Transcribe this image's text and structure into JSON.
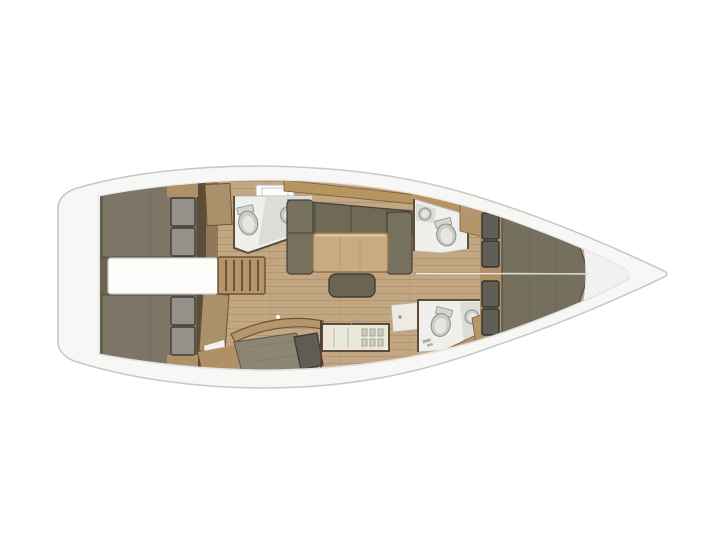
{
  "scene": {
    "type": "yacht-interior-floorplan",
    "view": "top-down",
    "orientation": "bow-right",
    "components": [
      "transom",
      "aft-cabin-top",
      "aft-cabin-bottom",
      "engine-compartment",
      "companionway-steps",
      "saloon",
      "saloon-settee",
      "saloon-table",
      "forward-head-port",
      "nav-chart-area",
      "galley",
      "shower-stall",
      "aft-head-starboard",
      "forward-head-starboard",
      "corridor",
      "forward-cabin",
      "v-berth",
      "bow-locker"
    ]
  },
  "colors": {
    "background": "#ffffff",
    "hull_fill": "#f7f7f5",
    "hull_outline": "#c9c9c6",
    "deck": "#eae9e5",
    "wood_floor": "#c3a783",
    "wood_plank_line": "#ab9270",
    "wood_wall": "#91785a",
    "wall_brown": "#5d4c38",
    "trim_brown": "#6e5333",
    "cabinetry_tan": "#b5956c",
    "cabinetry_dark_tan": "#b09066",
    "sloped_band_tan": "#b79560",
    "aft_band": "#6b654f",
    "berth_olive": "#7d7667",
    "vberth_olive": "#75705e",
    "settee_back": "#6f6958",
    "settee_arm": "#76705f",
    "cushion_outline": "#454134",
    "ottoman": "#6b6453",
    "pillow_gray": "#93918a",
    "pillow_dark": "#605e57",
    "table_wood": "#c9aa82",
    "table_edge": "#97764d",
    "engine_white": "#fcfcfa",
    "fixture_white": "#eff0ec",
    "fixture_outline": "#b7b7b2",
    "porcelain": "#c9cbc7",
    "porcelain_inner": "#e6e7e3",
    "counter_gray": "#dcddd8",
    "galley_counter": "#e9e7da",
    "shower_tile": "#edebe4",
    "chart_khaki": "#8b8573",
    "dark_cushion": "#5e5c54",
    "bow_white": "#f1f1ef",
    "hatch_white": "#fbfbf9",
    "centerline": "#f4f2ea",
    "door_wood": "#ab906c",
    "split_line": "#ddd9cf"
  }
}
